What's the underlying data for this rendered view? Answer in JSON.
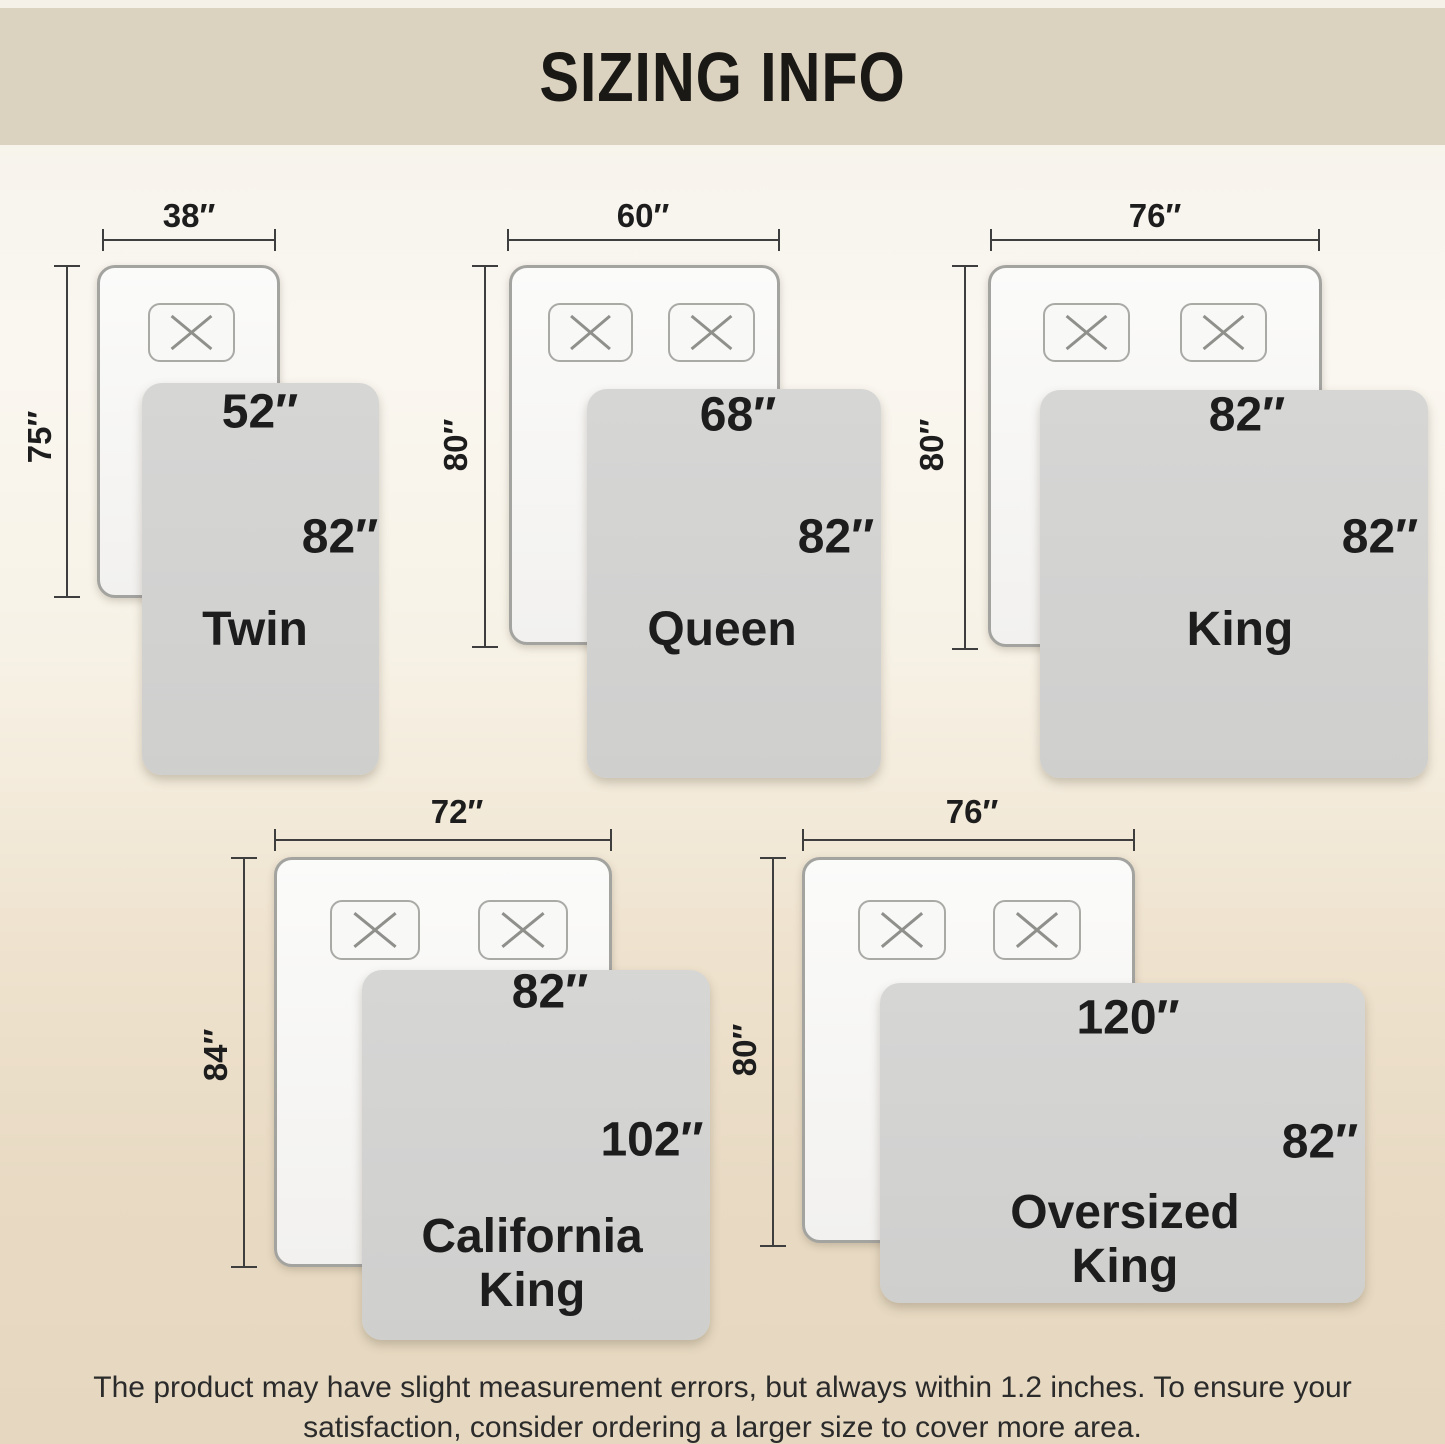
{
  "title": "SIZING INFO",
  "footnote": {
    "line1": "The product may have slight measurement errors, but always within 1.2 inches. To ensure your",
    "line2": "satisfaction, consider ordering a larger size to cover more area."
  },
  "beds": [
    {
      "id": "twin",
      "name_lines": [
        "Twin"
      ],
      "pillow_count": 1,
      "mattress_width_label": "38″",
      "mattress_length_label": "75″",
      "blanket_width_label": "52″",
      "blanket_length_label": "82″"
    },
    {
      "id": "queen",
      "name_lines": [
        "Queen"
      ],
      "pillow_count": 2,
      "mattress_width_label": "60″",
      "mattress_length_label": "80″",
      "blanket_width_label": "68″",
      "blanket_length_label": "82″"
    },
    {
      "id": "king",
      "name_lines": [
        "King"
      ],
      "pillow_count": 2,
      "mattress_width_label": "76″",
      "mattress_length_label": "80″",
      "blanket_width_label": "82″",
      "blanket_length_label": "82″"
    },
    {
      "id": "california-king",
      "name_lines": [
        "California",
        "King"
      ],
      "pillow_count": 2,
      "mattress_width_label": "72″",
      "mattress_length_label": "84″",
      "blanket_width_label": "82″",
      "blanket_length_label": "102″"
    },
    {
      "id": "oversized-king",
      "name_lines": [
        "Oversized",
        "King"
      ],
      "pillow_count": 2,
      "mattress_width_label": "76″",
      "mattress_length_label": "80″",
      "blanket_width_label": "120″",
      "blanket_length_label": "82″"
    }
  ],
  "colors": {
    "header_bg": "#dcd2c0",
    "background_top": "#f5f1e9",
    "background_bottom": "#e6d8c0",
    "blanket_gray": "#d2d2d2",
    "mattress_white": "#f8f8f7",
    "outline_gray": "#a3a3a0",
    "dimension_line": "#3e3e3e",
    "text_black": "#1d1d1d"
  }
}
